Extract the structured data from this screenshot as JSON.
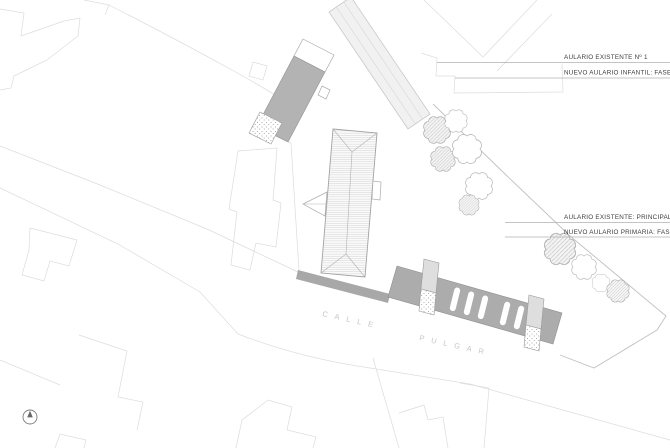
{
  "drawing": {
    "labels": {
      "group1": {
        "line1": "AULARIO EXISTENTE Nº 1",
        "line2": "NUEVO AULARIO INFANTIL: FASE 1"
      },
      "group2": {
        "line1": "AULARIO EXISTENTE: PRINCIPAL",
        "line2": "NUEVO AULARIO PRIMARIA: FASE 2"
      }
    },
    "street": {
      "word1": "CALLE",
      "word2": "PULGAR",
      "full_name": "CALLE PULGAR"
    }
  },
  "colors": {
    "parcel-line": "#dcdcdc",
    "boundary-line": "#c0c0c0",
    "leader-line": "#b0b0b0",
    "building-gray": "#b3b3b3",
    "slab-gray": "#acacac",
    "wall-gray": "#a8a8a8",
    "roof-line": "#a3a3a3",
    "label-ink": "#3c3c3c",
    "street-ink": "#c6c6c6"
  }
}
